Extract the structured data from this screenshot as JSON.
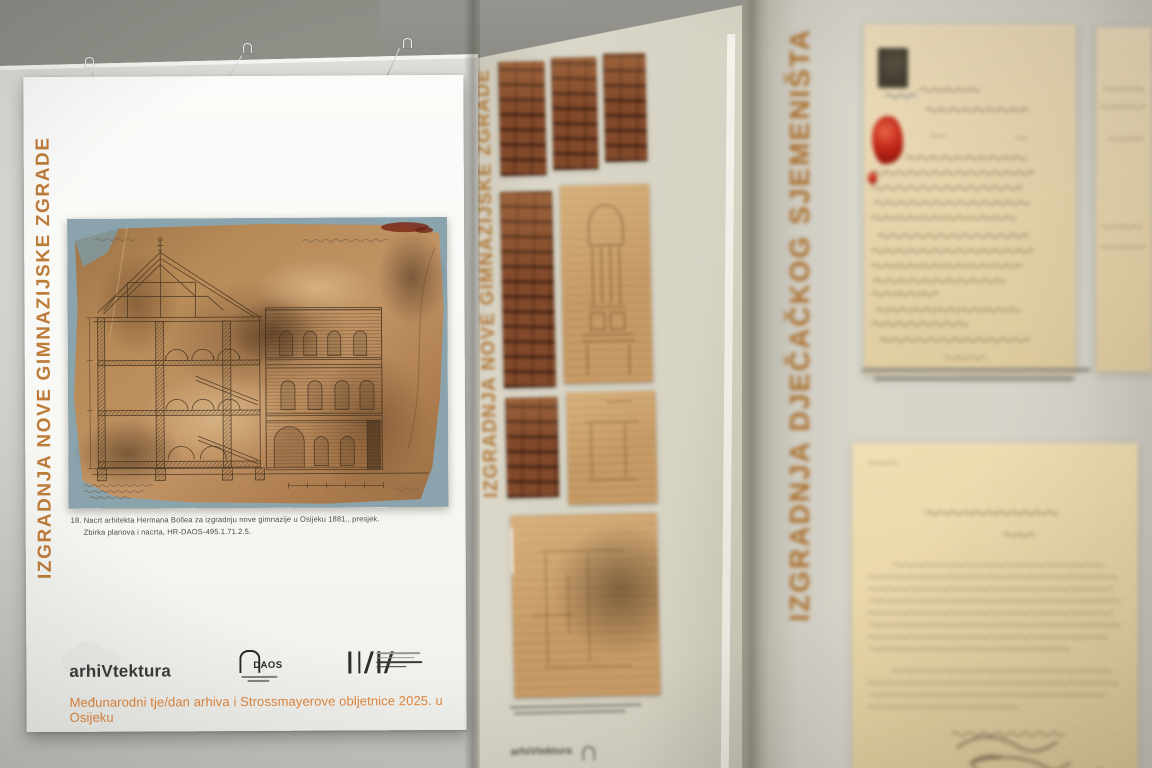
{
  "photo": {
    "subject": "Exhibition panels with archival architectural drawings and handwritten documents"
  },
  "left_poster": {
    "vertical_title": "IZGRADNJA NOVE GIMNAZIJSKE ZGRADE",
    "caption_line1": "18. Nacrt arhitekta Hermana Bollea za izgradnju nove gimnazije u Osijeku 1881., presjek.",
    "caption_line2": "Zbirka planova i nacrta, HR-DAOS-495.1.71.2.5.",
    "logo_arhivtektura": "arhiVtektura",
    "logo_daos": "DAOS",
    "footer_tagline": "Međunarodni tje/dan arhiva i Strossmayerove obljetnice 2025. u Osijeku",
    "accent_color": "#bd7c3a"
  },
  "middle_poster": {
    "vertical_title": "IZGRADNJA NOVE GIMNAZIJSKE ZGRADE",
    "footer_partial": "arhiVtektura"
  },
  "right_poster": {
    "vertical_title": "IZGRADNJA DJEČAČKOG SJEMENIŠTA",
    "accent_color": "#aa6f2d"
  }
}
